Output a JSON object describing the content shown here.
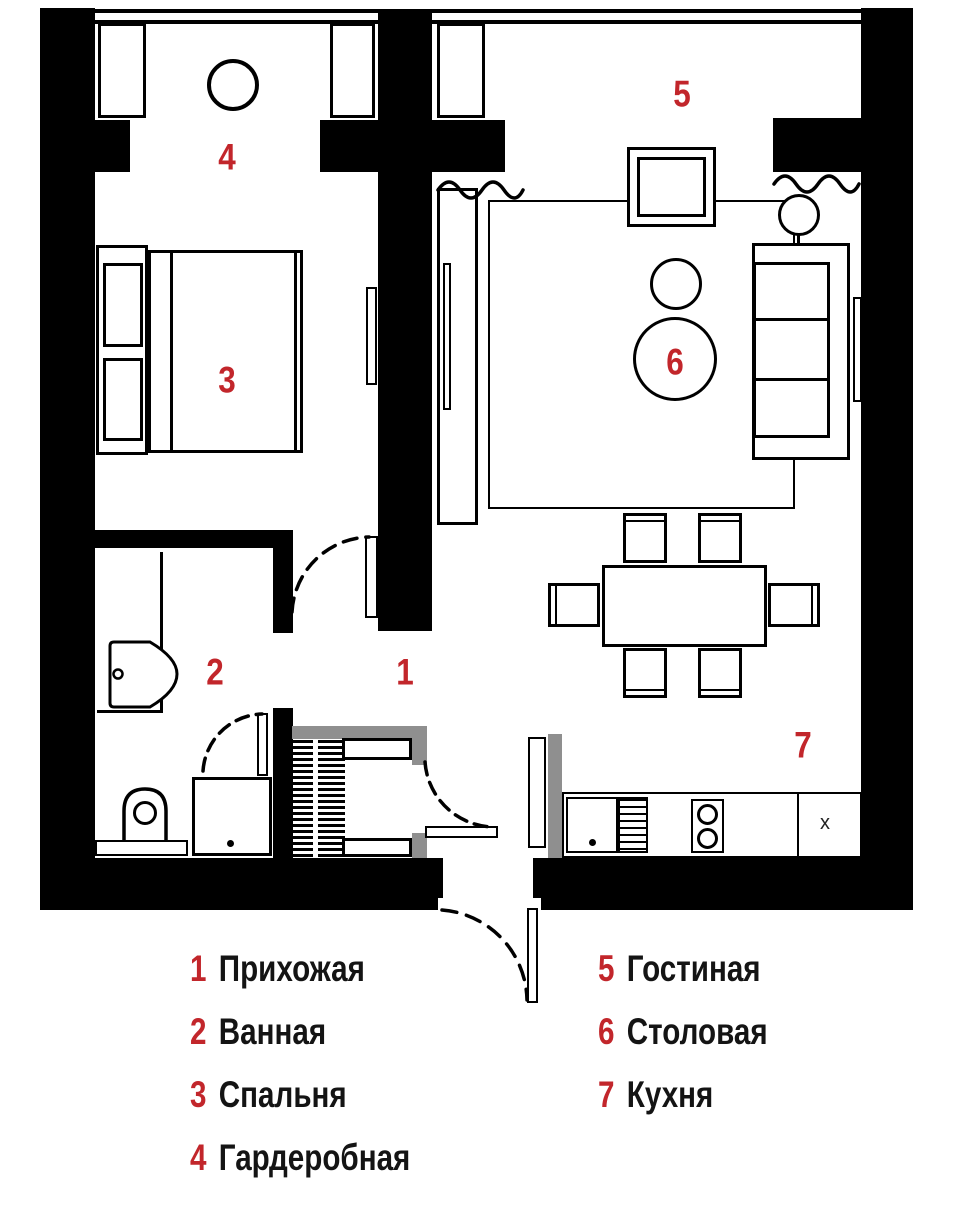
{
  "palette": {
    "wall": "#000000",
    "accent_red": "#C2262B",
    "gray": "#8F8F8F",
    "background": "#FFFFFF",
    "text": "#141414"
  },
  "rooms": [
    {
      "number": "1",
      "label": "Прихожая"
    },
    {
      "number": "2",
      "label": "Ванная"
    },
    {
      "number": "3",
      "label": "Спальня"
    },
    {
      "number": "4",
      "label": "Гардеробная"
    },
    {
      "number": "5",
      "label": "Гостиная"
    },
    {
      "number": "6",
      "label": "Столовая"
    },
    {
      "number": "7",
      "label": "Кухня"
    }
  ],
  "kitchen": {
    "unit_label": "x"
  },
  "symbols": [
    "wall-opening-squiggle",
    "door-swing-arc",
    "wardrobe-hanger-hatch",
    "sink-icon",
    "toilet-icon",
    "washing-machine-icon",
    "hob-icon",
    "sofa-icon",
    "bed-icon",
    "dining-table-icon",
    "floor-lamp-icon"
  ]
}
